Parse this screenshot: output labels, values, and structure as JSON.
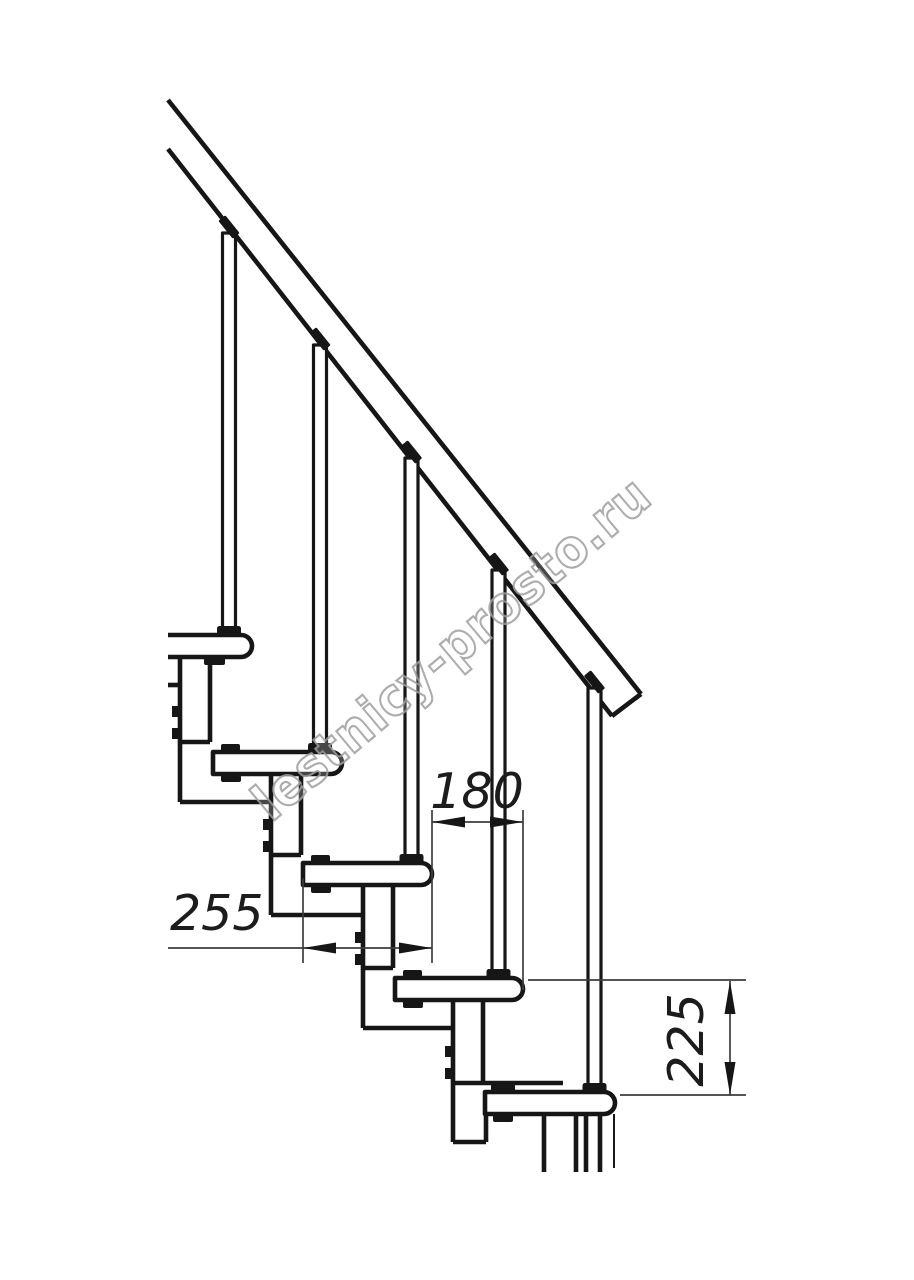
{
  "drawing": {
    "watermark_text": "lestnicy-prosto.ru",
    "dimensions": {
      "tread_depth": "255",
      "tread_offset": "180",
      "step_rise": "225"
    }
  },
  "colors": {
    "background": "#ffffff",
    "line_color": "#161616",
    "dimension_color": "#3d3d3d",
    "watermark_color": "#9f9f9f"
  }
}
